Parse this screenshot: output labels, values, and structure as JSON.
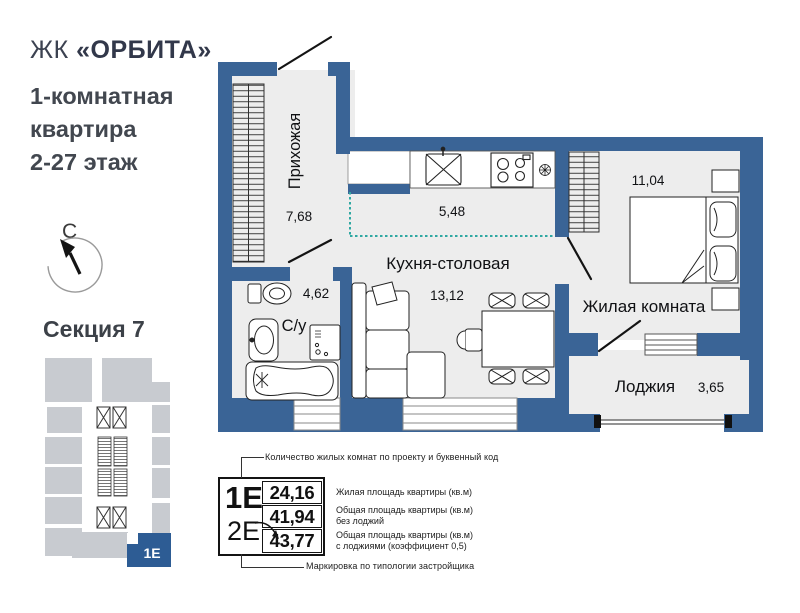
{
  "header": {
    "complex_prefix": "ЖК",
    "complex_name": "«ОРБИТА»",
    "subtitle_line1": "1-комнатная",
    "subtitle_line2": "квартира",
    "subtitle_line3": "2-27 этаж"
  },
  "compass": {
    "north_label": "С"
  },
  "section": {
    "title": "Секция 7",
    "highlight_label": "1Е"
  },
  "plan": {
    "rooms": [
      {
        "name": "Прихожая",
        "area": "7,68"
      },
      {
        "name": "Кухня-столовая",
        "area": "13,12"
      },
      {
        "name": "С/у",
        "area": "4,62"
      },
      {
        "name": "Жилая комната",
        "area": "11,04"
      },
      {
        "name": "Лоджия",
        "area": "3,65"
      }
    ],
    "zone_area": "5,48"
  },
  "legend": {
    "type_code_primary": "1Е",
    "type_code_secondary": "2Е",
    "rows": [
      {
        "value": "24,16",
        "label1": "Жилая площадь квартиры (кв.м)",
        "label2": ""
      },
      {
        "value": "41,94",
        "label1": "Общая площадь квартиры (кв.м)",
        "label2": "без лоджий"
      },
      {
        "value": "43,77",
        "label1": "Общая площадь квартиры (кв.м)",
        "label2": "с лоджиями (коэффициент 0,5)"
      }
    ],
    "top_note": "Количество жилых комнат по проекту и буквенный код",
    "bottom_note": "Маркировка по типологии застройщика"
  },
  "colors": {
    "wall": "#3a6496",
    "floor": "#ededed",
    "minimap_gray": "#c8cbd0",
    "accent_blue": "#2d5c94",
    "dotted_line": "#2fa8a2"
  }
}
